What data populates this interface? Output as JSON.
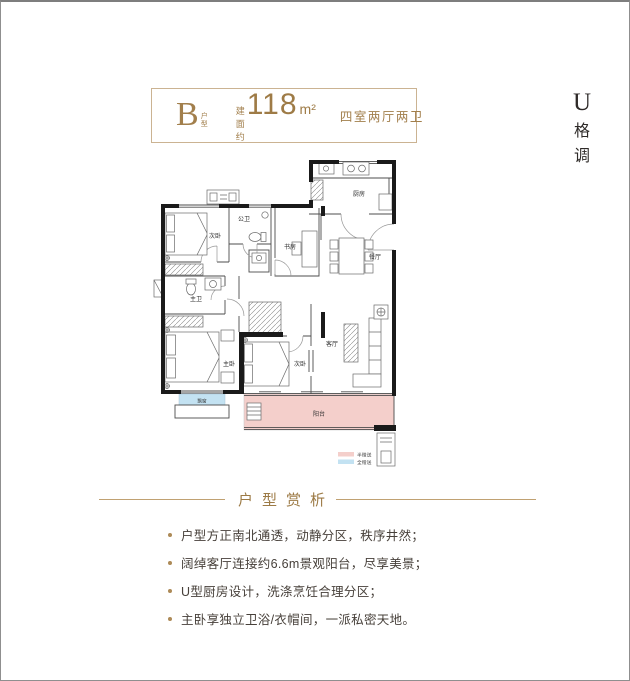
{
  "header": {
    "type_letter": "B",
    "type_label": "户型",
    "area_prefix": "建面约",
    "area_value": "118",
    "area_unit": "m²",
    "layout_text": "四室两厅两卫",
    "accent_color": "#a27f4c"
  },
  "brand": {
    "logo": "U",
    "chars": [
      "格",
      "调"
    ]
  },
  "floorplan": {
    "wall_color": "#1a1a1a",
    "rooms": [
      {
        "name": "secondary-bedroom-north",
        "label": "次卧"
      },
      {
        "name": "public-bathroom",
        "label": "公卫"
      },
      {
        "name": "study",
        "label": "书房"
      },
      {
        "name": "kitchen",
        "label": "厨房"
      },
      {
        "name": "dining-room",
        "label": "餐厅"
      },
      {
        "name": "master-bathroom",
        "label": "主卫"
      },
      {
        "name": "master-bedroom",
        "label": "主卧"
      },
      {
        "name": "secondary-bedroom-south",
        "label": "次卧"
      },
      {
        "name": "living-room",
        "label": "客厅"
      },
      {
        "name": "balcony",
        "label": "阳台"
      },
      {
        "name": "bay-window",
        "label": "飘窗"
      }
    ],
    "legend": [
      {
        "label": "半赠送",
        "color": "#f4cfcb"
      },
      {
        "label": "全赠送",
        "color": "#c3e2f2"
      }
    ]
  },
  "analysis": {
    "title": "户型赏析",
    "bullets": [
      "户型方正南北通透，动静分区，秩序井然；",
      "阔绰客厅连接约6.6m景观阳台，尽享美景；",
      "U型厨房设计，洗涤烹饪合理分区；",
      "主卧享独立卫浴/衣帽间，一派私密天地。"
    ]
  }
}
